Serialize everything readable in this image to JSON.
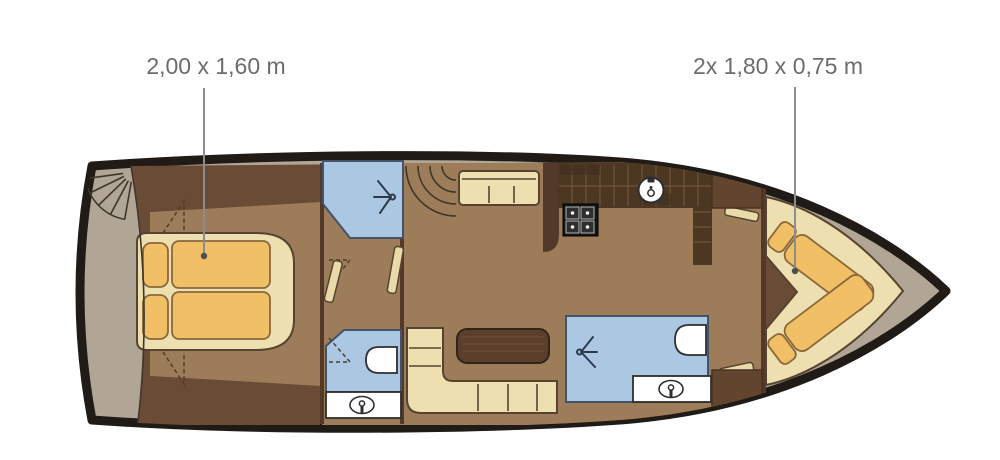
{
  "plan": {
    "type": "yacht-interior-floor-plan",
    "annotations": {
      "master_bed_size": "2,00 x 1,60 m",
      "twin_beds_size": "2x 1,80 x 0,75 m"
    },
    "icons": [
      "spiral-stairs-icon",
      "shower-spray-icon",
      "toilet-icon",
      "washbasin-icon",
      "stove-icon",
      "sink-icon"
    ],
    "colors": {
      "hull_outline": "#201b16",
      "deck": "#b1a695",
      "cabin_wall": "#6a4c36",
      "cabin_floor": "#9c7c59",
      "furniture_cream": "#eedfb0",
      "mattress_orange": "#f1bf66",
      "wet_room_blue": "#abc7e2",
      "galley_cabinet": "#4c3723",
      "table_brown": "#5b3f2b",
      "fixture_white": "#ffffff",
      "label_text": "#6c6c6c"
    }
  }
}
